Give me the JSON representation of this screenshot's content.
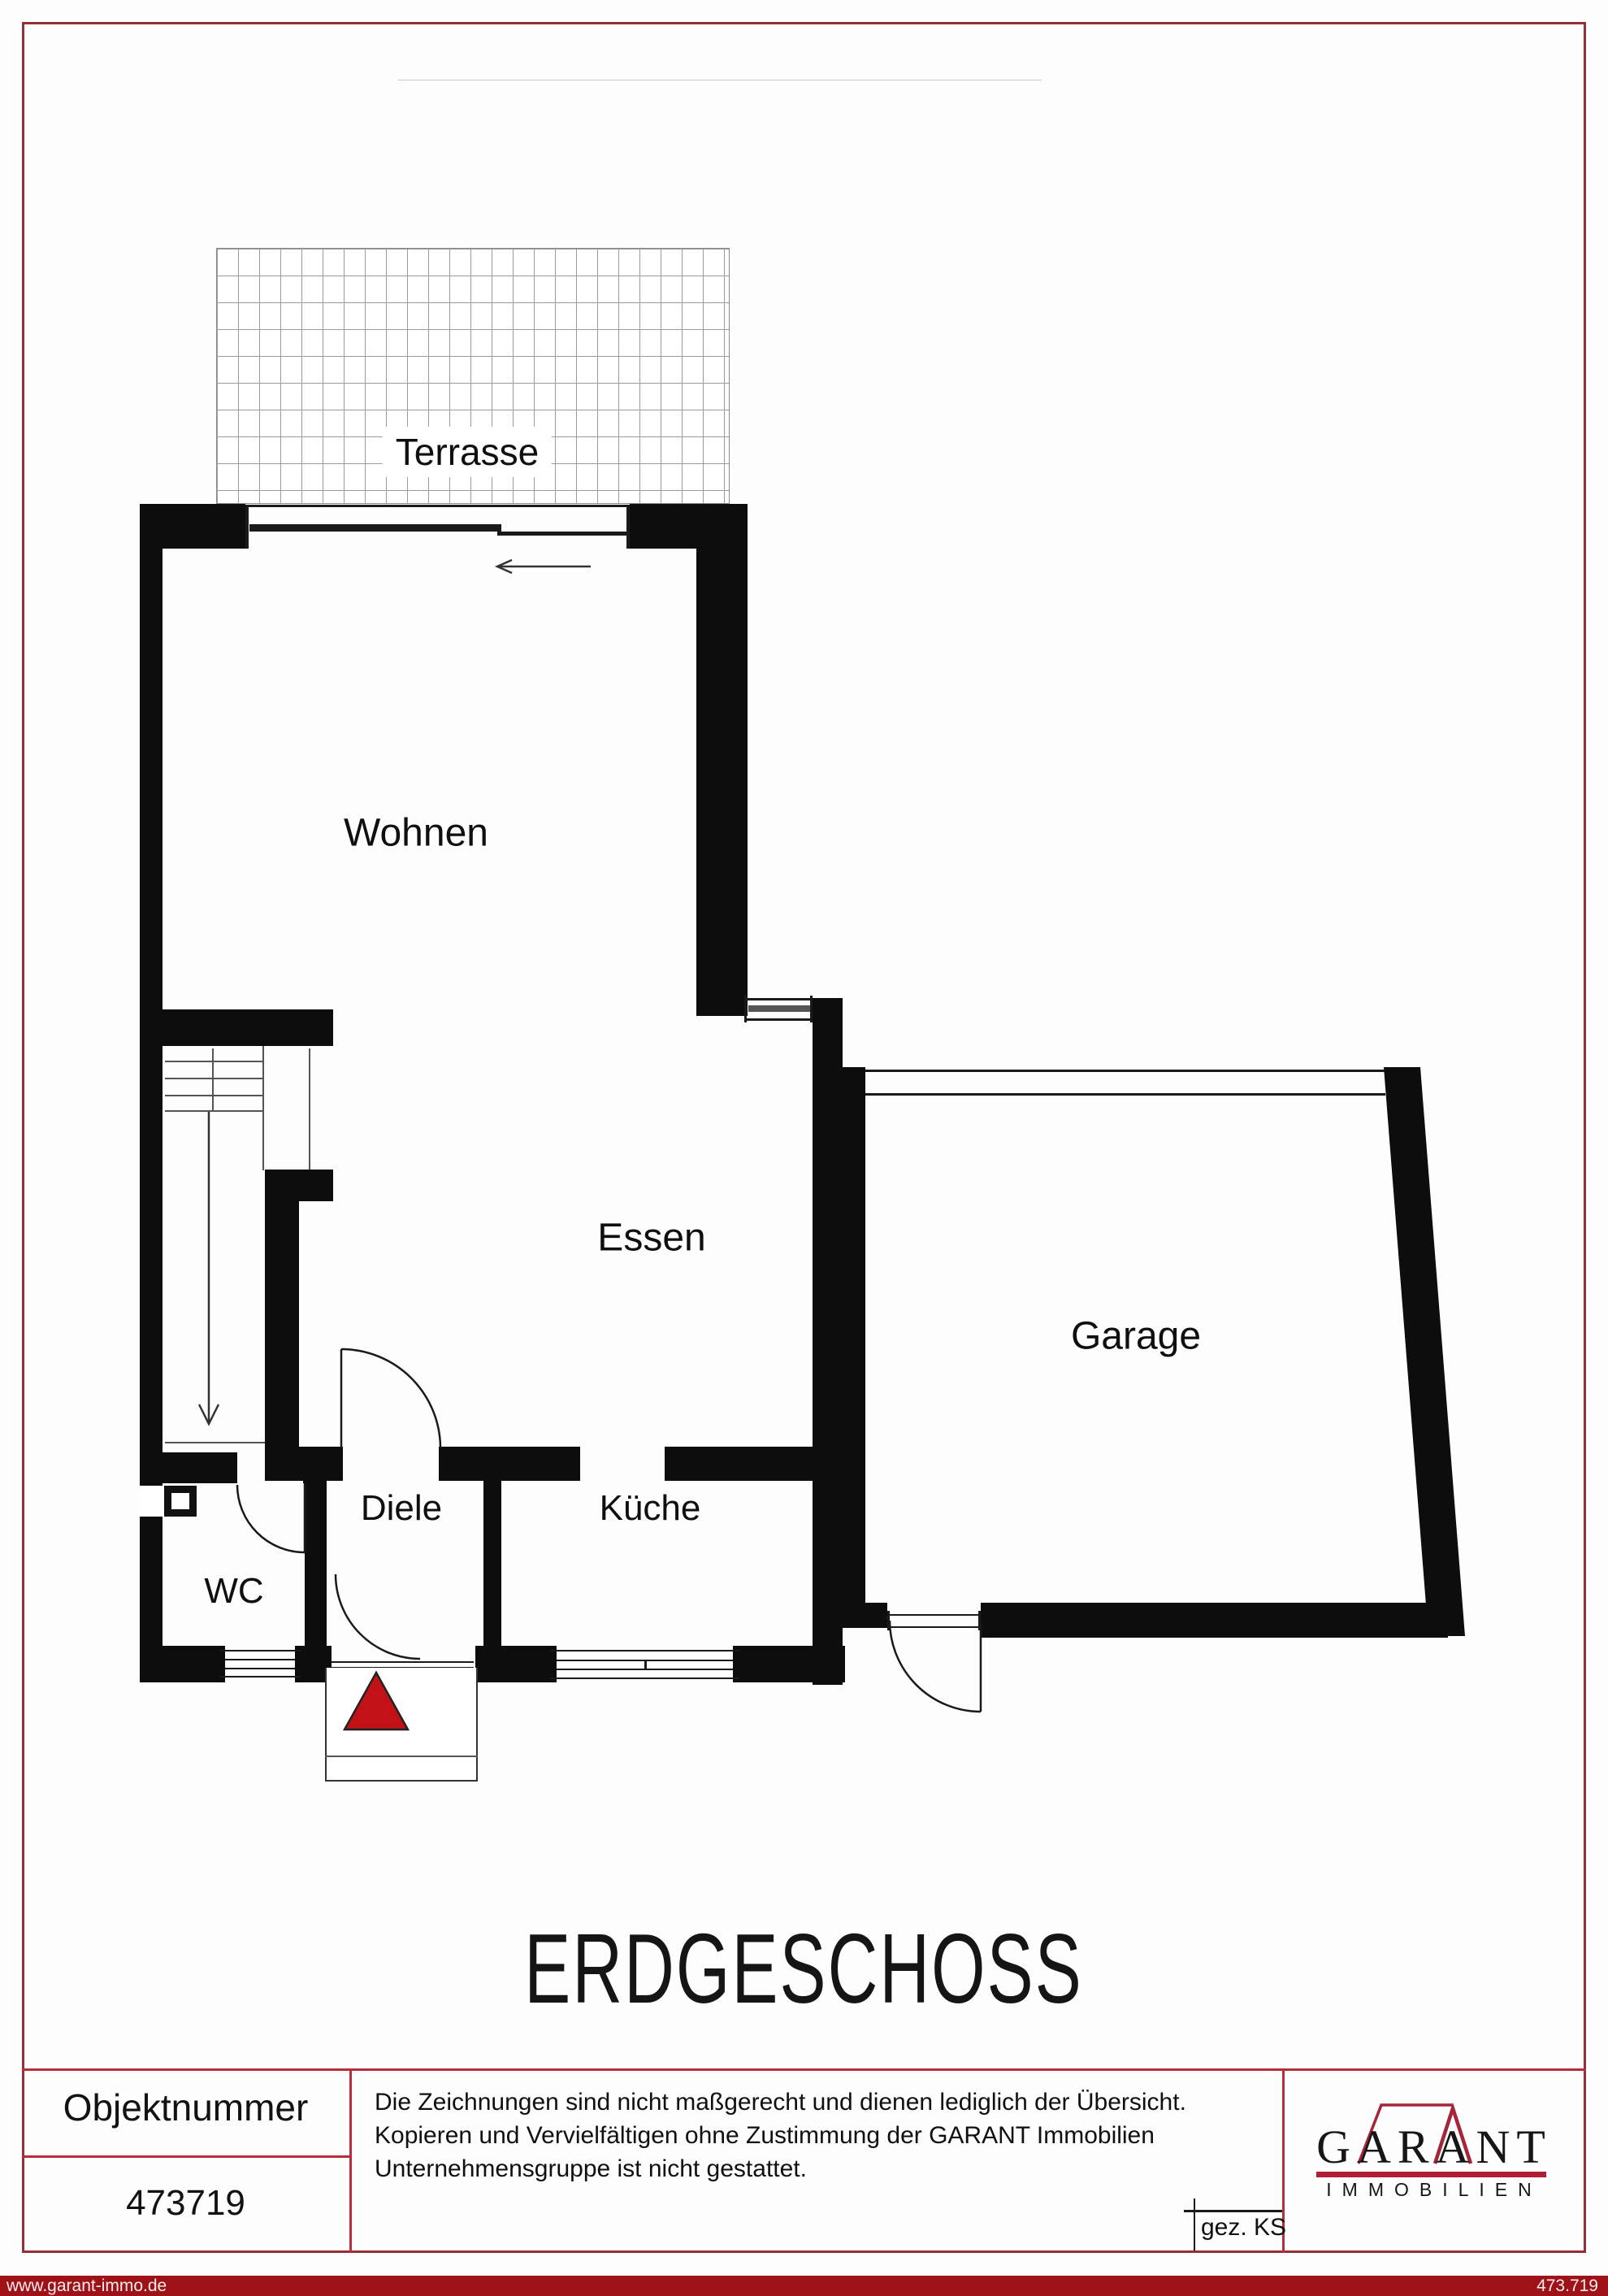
{
  "page": {
    "floor_title": "ERDGESCHOSS"
  },
  "plan": {
    "rooms": {
      "terrace": "Terrasse",
      "living": "Wohnen",
      "dining": "Essen",
      "garage": "Garage",
      "hall": "Diele",
      "kitchen": "Küche",
      "wc": "WC"
    }
  },
  "footer": {
    "object_number_label": "Objektnummer",
    "object_number": "473719",
    "disclaimer": {
      "line1": "Die Zeichnungen sind nicht maßgerecht und dienen lediglich der Übersicht.",
      "line2": "Kopieren und Vervielfältigen ohne Zustimmung der GARANT Immobilien",
      "line3": "Unternehmensgruppe ist nicht gestattet."
    },
    "drawn_by": "gez. KS",
    "logo": {
      "brand": "GARANT",
      "division": "IMMOBILIEN"
    }
  },
  "bottom_bar": {
    "website": "www.garant-immo.de",
    "reference": "473.719"
  },
  "colors": {
    "line_red": "#b52f38",
    "border_red": "#943137",
    "footer_bar_red": "#9e1117",
    "logo_red": "#a62639",
    "logo_bar_red": "#b01e36",
    "triangle_red": "#c31118"
  }
}
